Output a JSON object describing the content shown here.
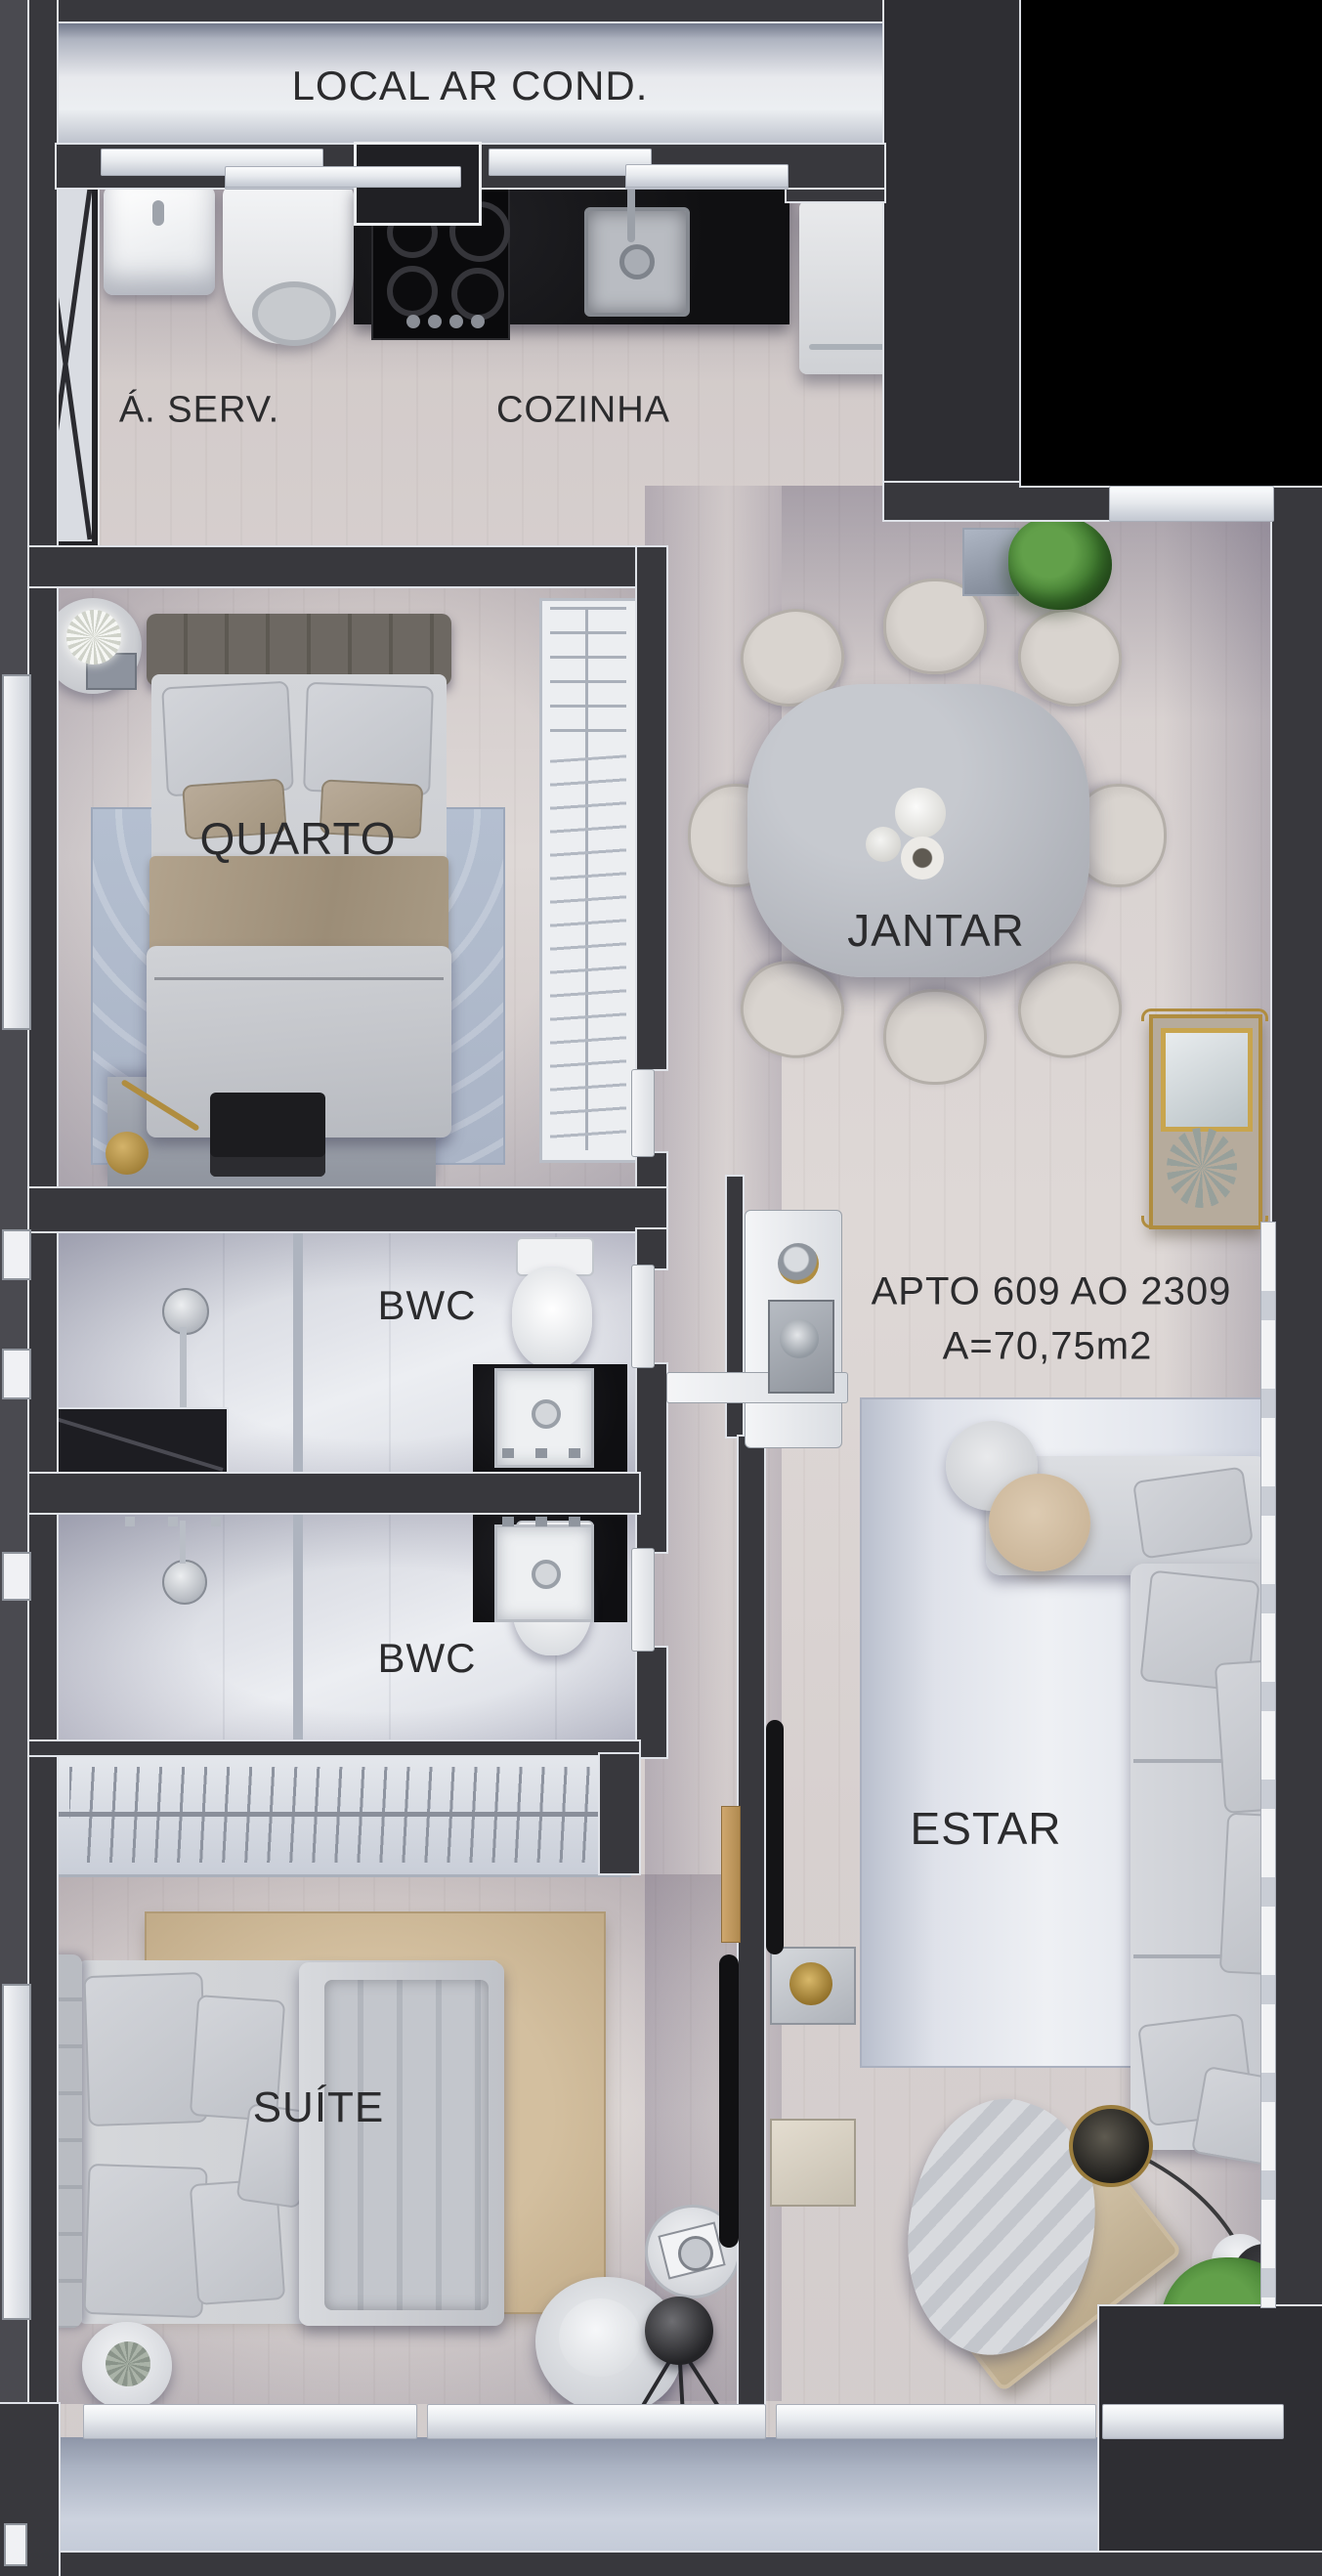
{
  "plan": {
    "title": "Apartment floor plan",
    "unit": {
      "line1": "APTO 609 AO  2309",
      "line2": "A=70,75m2"
    },
    "rooms": {
      "local_ar_cond": {
        "label": "LOCAL AR COND."
      },
      "area_servico": {
        "label": "Á. SERV."
      },
      "cozinha": {
        "label": "COZINHA"
      },
      "quarto": {
        "label": "QUARTO"
      },
      "jantar": {
        "label": "JANTAR"
      },
      "bwc1": {
        "label": "BWC"
      },
      "bwc2": {
        "label": "BWC"
      },
      "estar": {
        "label": "ESTAR"
      },
      "suite": {
        "label": "SUÍTE"
      }
    },
    "colors": {
      "wall": "#38383d",
      "wall_trim": "#dfe2e8",
      "void_black": "#000000",
      "wood_floor": "#d8d1d0",
      "tile_floor": "#e2e4ea",
      "rug_quarto": "#b7c1d2",
      "rug_suite": "#c9b393",
      "rug_estar": "#dde1e9",
      "marble_table": "#b6b9bf",
      "counter_black": "#141416",
      "gold_accent": "#b08d3f",
      "plant_green": "#3f7a2f"
    }
  }
}
